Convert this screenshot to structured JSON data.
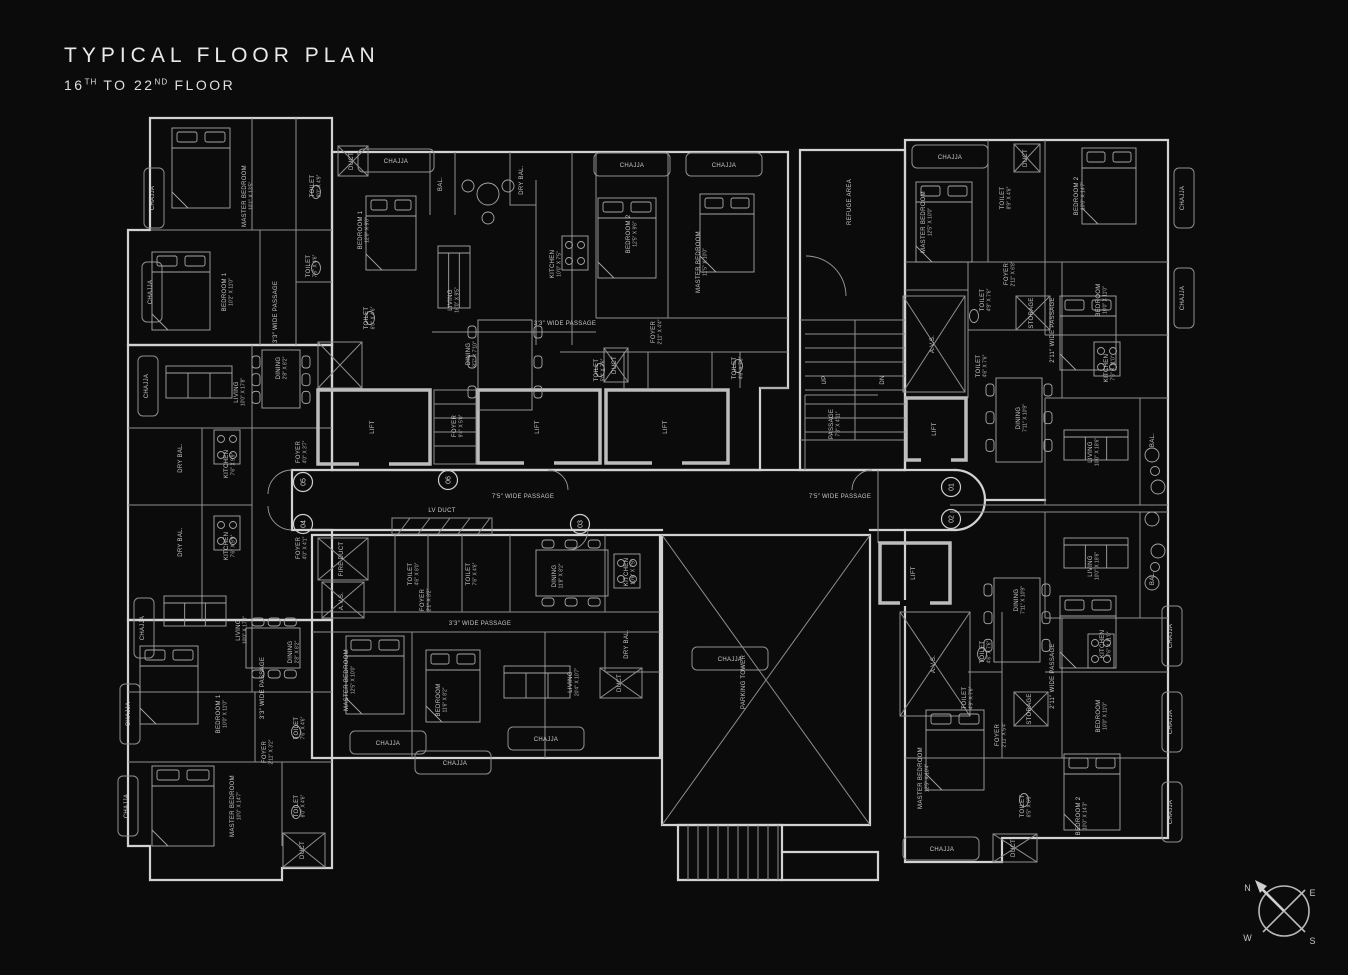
{
  "header": {
    "title": "TYPICAL FLOOR PLAN",
    "sub_16": "16",
    "sub_th": "TH",
    "sub_to": " TO 22",
    "sub_nd": "ND",
    "sub_floor": " FLOOR"
  },
  "compass": {
    "n": "N",
    "e": "E",
    "w": "W",
    "s": "S"
  },
  "colors": {
    "background": "#0b0b0b",
    "wall": "#d2d2d2",
    "inner_wall": "#8f8f8f",
    "text": "#c9c9c9"
  },
  "plan": {
    "units": [
      {
        "n": "05",
        "x": 303,
        "y": 482
      },
      {
        "n": "06",
        "x": 448,
        "y": 480
      },
      {
        "n": "04",
        "x": 303,
        "y": 524
      },
      {
        "n": "03",
        "x": 580,
        "y": 524
      },
      {
        "n": "01",
        "x": 951,
        "y": 487
      },
      {
        "n": "02",
        "x": 951,
        "y": 519
      }
    ],
    "labels": [
      {
        "t": "MASTER BEDROOM",
        "d": "10'1″ X 13'5″",
        "x": 246,
        "y": 196
      },
      {
        "t": "TOILET",
        "d": "8'0″ X 4'9″",
        "x": 314,
        "y": 186
      },
      {
        "t": "BEDROOM 1",
        "d": "12'0″ X 9'8″",
        "x": 362,
        "y": 230
      },
      {
        "t": "TOILET",
        "d": "7'6″ X 4'6″",
        "x": 310,
        "y": 266
      },
      {
        "t": "BEDROOM 1",
        "d": "10'2″ X 11'0″",
        "x": 226,
        "y": 292
      },
      {
        "t": "3'3″ WIDE PASSAGE",
        "x": 277,
        "y": 312
      },
      {
        "t": "TOILET",
        "d": "6'0″ X 4'6″",
        "x": 368,
        "y": 318
      },
      {
        "t": "DINING",
        "d": "2'8″ X 8'2″",
        "x": 280,
        "y": 368
      },
      {
        "t": "LIVING",
        "d": "10'0″ X 17'8″",
        "x": 238,
        "y": 392
      },
      {
        "t": "DRY BAL.",
        "x": 182,
        "y": 458
      },
      {
        "t": "KITCHEN",
        "d": "7'6″ X 9'9″",
        "x": 228,
        "y": 464
      },
      {
        "t": "FOYER",
        "d": "4'0″ X 3'7″",
        "x": 300,
        "y": 452
      },
      {
        "t": "DRY BAL.",
        "x": 182,
        "y": 542
      },
      {
        "t": "KITCHEN",
        "d": "7'6″ X 9'9″",
        "x": 228,
        "y": 546
      },
      {
        "t": "FOYER",
        "d": "4'0″ X 4'1″",
        "x": 300,
        "y": 548
      },
      {
        "t": "BAL.",
        "x": 442,
        "y": 184
      },
      {
        "t": "DRY BAL.",
        "x": 523,
        "y": 180
      },
      {
        "t": "LIVING",
        "d": "16'0″ X 9'5″",
        "x": 452,
        "y": 300
      },
      {
        "t": "KITCHEN",
        "d": "10'0″ X 7'5″",
        "x": 554,
        "y": 264
      },
      {
        "t": "BEDROOM 2",
        "d": "12'5″ X 9'6″",
        "x": 630,
        "y": 234
      },
      {
        "t": "MASTER BEDROOM",
        "d": "11'5″ X 10'0″",
        "x": 700,
        "y": 262
      },
      {
        "t": "3'3″ WIDE PASSAGE",
        "x": 565,
        "y": 325,
        "r": 0
      },
      {
        "t": "DINING",
        "d": "8'7″ X 7'10″",
        "x": 470,
        "y": 354
      },
      {
        "t": "FOYER",
        "d": "2'11″ X 4'4″",
        "x": 655,
        "y": 332
      },
      {
        "t": "TOILET",
        "d": "5'0″ X 7'6″",
        "x": 598,
        "y": 370
      },
      {
        "t": "TOILET",
        "d": "4'6″ X 7'6″",
        "x": 736,
        "y": 368
      },
      {
        "t": "LIFT",
        "x": 374,
        "y": 427
      },
      {
        "t": "FOYER",
        "d": "9'4″ X 5'0″",
        "x": 456,
        "y": 426
      },
      {
        "t": "LIFT",
        "x": 539,
        "y": 427
      },
      {
        "t": "LIFT",
        "x": 667,
        "y": 427
      },
      {
        "t": "LIFT",
        "x": 936,
        "y": 429
      },
      {
        "t": "LIFT",
        "x": 915,
        "y": 573
      },
      {
        "t": "7'5″ WIDE PASSAGE",
        "x": 523,
        "y": 498,
        "r": 0
      },
      {
        "t": "7'5″ WIDE PASSAGE",
        "x": 840,
        "y": 498,
        "r": 0
      },
      {
        "t": "LV DUCT",
        "x": 442,
        "y": 512,
        "r": 0
      },
      {
        "t": "PASSAGE",
        "d": "7'3″ X 4'11″",
        "x": 833,
        "y": 424
      },
      {
        "t": "REFUGE AREA",
        "x": 851,
        "y": 202
      },
      {
        "t": "UP",
        "x": 826,
        "y": 380
      },
      {
        "t": "DN",
        "x": 884,
        "y": 380
      },
      {
        "t": "MASTER BEDROOM",
        "d": "12'5″ X 10'0″",
        "x": 925,
        "y": 222
      },
      {
        "t": "TOILET",
        "d": "8'9″ X 4'6″",
        "x": 1004,
        "y": 198
      },
      {
        "t": "BEDROOM 2",
        "d": "10'0″ X 14'7″",
        "x": 1078,
        "y": 196
      },
      {
        "t": "FOYER",
        "d": "2'11″ X 6'8″",
        "x": 1008,
        "y": 274
      },
      {
        "t": "TOILET",
        "d": "4'9″ X 7'6″",
        "x": 984,
        "y": 300
      },
      {
        "t": "STORAGE",
        "x": 1033,
        "y": 313
      },
      {
        "t": "2'11″ WIDE PASSAGE",
        "x": 1054,
        "y": 330
      },
      {
        "t": "BEDROOM",
        "d": "10'0″ X 11'0″",
        "x": 1100,
        "y": 300
      },
      {
        "t": "A.V.S.",
        "x": 934,
        "y": 344
      },
      {
        "t": "TOILET",
        "d": "4'6″ X 7'6″",
        "x": 980,
        "y": 366
      },
      {
        "t": "KITCHEN",
        "d": "7'6″ X 11'0″",
        "x": 1108,
        "y": 368
      },
      {
        "t": "DINING",
        "d": "7'11″ X 10'9″",
        "x": 1020,
        "y": 418
      },
      {
        "t": "LIVING",
        "d": "10'0″ X 18'6″",
        "x": 1092,
        "y": 452
      },
      {
        "t": "BAL.",
        "x": 1154,
        "y": 440
      },
      {
        "t": "LIVING",
        "d": "10'0″ X 18'6″",
        "x": 1092,
        "y": 566
      },
      {
        "t": "BAL.",
        "x": 1154,
        "y": 578
      },
      {
        "t": "DINING",
        "d": "7'11″ X 10'9″",
        "x": 1018,
        "y": 600
      },
      {
        "t": "KITCHEN",
        "d": "7'6″ X 11'0″",
        "x": 1104,
        "y": 644
      },
      {
        "t": "A.V.S.",
        "x": 935,
        "y": 664
      },
      {
        "t": "TOILET",
        "d": "4'6″ X 7'6″",
        "x": 984,
        "y": 652
      },
      {
        "t": "2'11″ WIDE PASSAGE",
        "x": 1054,
        "y": 676
      },
      {
        "t": "TOILET",
        "d": "4'9″ X 7'6″",
        "x": 966,
        "y": 698
      },
      {
        "t": "STORAGE",
        "x": 1031,
        "y": 709
      },
      {
        "t": "FOYER",
        "d": "2'11″ X 5'4″",
        "x": 999,
        "y": 735
      },
      {
        "t": "BEDROOM",
        "d": "10'0″ X 11'0″",
        "x": 1100,
        "y": 716
      },
      {
        "t": "MASTER BEDROOM",
        "d": "12'5″ X 10'4″",
        "x": 922,
        "y": 778
      },
      {
        "t": "TOILET",
        "d": "6'5″ X 8'9″",
        "x": 1024,
        "y": 806
      },
      {
        "t": "BEDROOM 2",
        "d": "10'0″ X 14'3″",
        "x": 1080,
        "y": 816
      },
      {
        "t": "FIRE DUCT",
        "x": 343,
        "y": 559
      },
      {
        "t": "A.V.S.",
        "x": 343,
        "y": 601
      },
      {
        "t": "TOILET",
        "d": "4'6″ X 8'0″",
        "x": 412,
        "y": 574
      },
      {
        "t": "TOILET",
        "d": "7'6″ X 4'6″",
        "x": 470,
        "y": 574
      },
      {
        "t": "FOYER",
        "d": "2'1″ X 3'2″",
        "x": 424,
        "y": 600
      },
      {
        "t": "DINING",
        "d": "11'8″ X 8'2″",
        "x": 556,
        "y": 576
      },
      {
        "t": "KITCHEN",
        "d": "10'6″ X 7'9″",
        "x": 628,
        "y": 572
      },
      {
        "t": "3'3″ WIDE PASSAGE",
        "x": 480,
        "y": 625,
        "r": 0
      },
      {
        "t": "MASTER BEDROOM",
        "d": "12'5″ X 10'0″",
        "x": 348,
        "y": 680
      },
      {
        "t": "BEDROOM",
        "d": "11'6″ X 8'2″",
        "x": 440,
        "y": 700
      },
      {
        "t": "LIVING",
        "d": "20'4″ X 10'7″",
        "x": 572,
        "y": 682
      },
      {
        "t": "DRY BAL.",
        "x": 628,
        "y": 644
      },
      {
        "t": "DUCT",
        "x": 621,
        "y": 683
      },
      {
        "t": "PARKING TOWER",
        "x": 745,
        "y": 682
      },
      {
        "t": "LIVING",
        "d": "10'0″ X 17'8″",
        "x": 240,
        "y": 630
      },
      {
        "t": "DINING",
        "d": "2'8″ X 8'2″",
        "x": 292,
        "y": 652
      },
      {
        "t": "BEDROOM 1",
        "d": "10'0″ X 11'0″",
        "x": 220,
        "y": 714
      },
      {
        "t": "3'3″ WIDE PASSAGE",
        "x": 264,
        "y": 688
      },
      {
        "t": "TOILET",
        "d": "7'6″ X 4'6″",
        "x": 298,
        "y": 728
      },
      {
        "t": "FOYER",
        "d": "2'11″ X 3'2″",
        "x": 266,
        "y": 752
      },
      {
        "t": "MASTER BEDROOM",
        "d": "10'0″ X 14'7″",
        "x": 234,
        "y": 806
      },
      {
        "t": "TOILET",
        "d": "8'0″ X 4'6″",
        "x": 298,
        "y": 806
      },
      {
        "t": "DUCT",
        "x": 304,
        "y": 850
      },
      {
        "t": "DUCT",
        "x": 353,
        "y": 161
      },
      {
        "t": "DUCT",
        "x": 616,
        "y": 365
      },
      {
        "t": "DUCT",
        "x": 1027,
        "y": 158
      },
      {
        "t": "DUCT",
        "x": 1015,
        "y": 848
      },
      {
        "t": "CHAJJA",
        "x": 154,
        "y": 198
      },
      {
        "t": "CHAJJA",
        "x": 152,
        "y": 292
      },
      {
        "t": "CHAJJA",
        "x": 148,
        "y": 386
      },
      {
        "t": "CHAJJA",
        "x": 144,
        "y": 628
      },
      {
        "t": "CHAJJA",
        "x": 130,
        "y": 714
      },
      {
        "t": "CHAJJA",
        "x": 128,
        "y": 806
      },
      {
        "t": "CHAJJA",
        "x": 1184,
        "y": 198
      },
      {
        "t": "CHAJJA",
        "x": 1184,
        "y": 298
      },
      {
        "t": "CHAJJA",
        "x": 1172,
        "y": 636
      },
      {
        "t": "CHAJJA",
        "x": 1172,
        "y": 722
      },
      {
        "t": "CHAJJA",
        "x": 1172,
        "y": 812
      },
      {
        "t": "CHAJJA",
        "x": 396,
        "y": 163,
        "r": 0
      },
      {
        "t": "CHAJJA",
        "x": 632,
        "y": 167,
        "r": 0
      },
      {
        "t": "CHAJJA",
        "x": 724,
        "y": 167,
        "r": 0
      },
      {
        "t": "CHAJJA",
        "x": 950,
        "y": 159,
        "r": 0
      },
      {
        "t": "CHAJJA",
        "x": 388,
        "y": 745,
        "r": 0
      },
      {
        "t": "CHAJJA",
        "x": 546,
        "y": 741,
        "r": 0
      },
      {
        "t": "CHAJJA",
        "x": 455,
        "y": 765,
        "r": 0
      },
      {
        "t": "CHAJJA",
        "x": 730,
        "y": 661,
        "r": 0
      },
      {
        "t": "CHAJJA",
        "x": 942,
        "y": 851,
        "r": 0
      }
    ]
  }
}
